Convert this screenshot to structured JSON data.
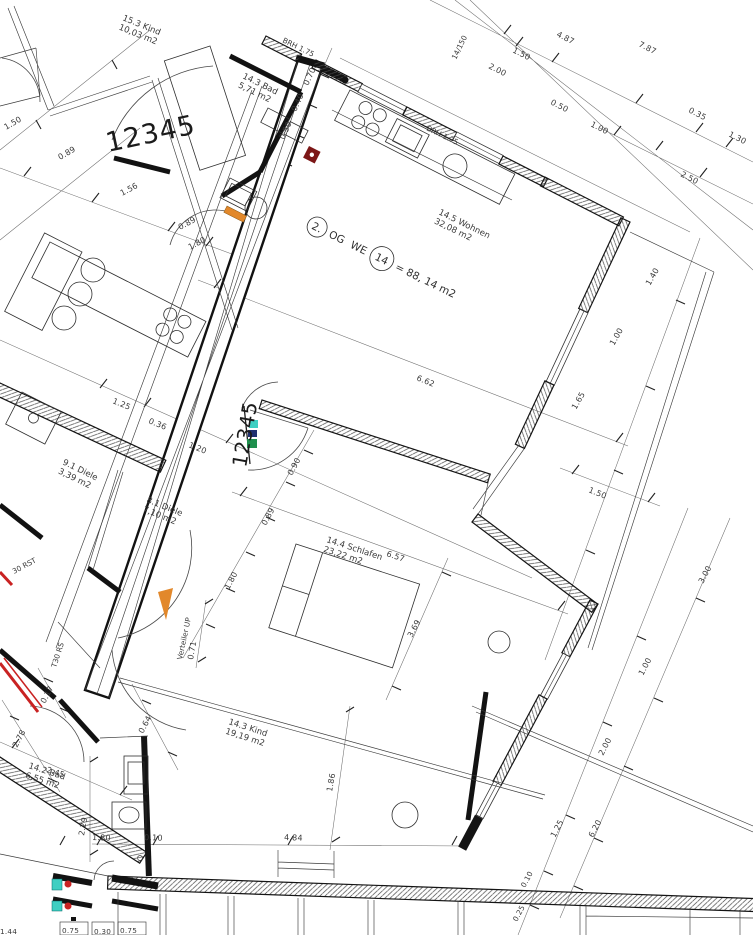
{
  "unit": {
    "floor": "2.",
    "og": "OG",
    "we": "WE",
    "number": "14",
    "area": "= 88, 14 m2"
  },
  "rooms": {
    "kind15": {
      "line1": "15.3 Kind",
      "line2": "10,03 m2"
    },
    "bad_top": {
      "line1": "14.3 Bad",
      "line2": "5,71 m2"
    },
    "wohnen": {
      "line1": "14.5 Wohnen",
      "line2": "32,08 m2"
    },
    "diele9": {
      "line1": "9.1 Diele",
      "line2": "3,39 m2"
    },
    "diele8": {
      "line1": "8.1 Diele",
      "line2": "7,10 m2"
    },
    "schlafen": {
      "line1": "14.4 Schlafen",
      "line2": "23,22 m2"
    },
    "kind14": {
      "line1": "14.3 Kind",
      "line2": "19,19 m2"
    },
    "bad_bottom": {
      "line1": "14.2 Bad",
      "line2": "6,55 m2"
    }
  },
  "stamps": {
    "a": "12345",
    "b": "12345"
  },
  "labels": {
    "brh1": "BRH 1.75",
    "brh2": "BRH 1.75",
    "stair": "14/150",
    "verteiler": "Verteiler UP",
    "t30": "T30 RS",
    "rst": "30 RST"
  },
  "dims": {
    "d01": "1.50",
    "d02": "0.89",
    "d03": "1.56",
    "d04": "0.89",
    "d05": "1.80",
    "d06": "1.50",
    "d08": "2.00",
    "d09": "4.87",
    "d10": "7.87",
    "d11": "0.50",
    "d12": "1.00",
    "d13": "0.35",
    "d14": "1.30",
    "d15": "2.50",
    "d16": "0.70",
    "d17": "0.40",
    "d18": "0.50",
    "d21": "1.40",
    "d22": "1.00",
    "d23": "1.65",
    "d24": "6.62",
    "d25": "1.50",
    "d26": "1.25",
    "d27": "0.36",
    "d28": "1.20",
    "d29": "0.90",
    "d30": "0.89",
    "d31": "1.80",
    "d32": "6.57",
    "d33": "3.69",
    "d34": "0.71",
    "d35": "0.17",
    "d36": "2.78",
    "d37": "0.64",
    "d38": "2.45",
    "d39": "2.29",
    "d40": "1.80",
    "d41": "0.10",
    "d42": "4.84",
    "d43": "1.86",
    "d44": "1.44",
    "d45": "0.75",
    "d46": "0.30",
    "d47": "0.75",
    "d48": "3.00",
    "d49": "1.00",
    "d50": "2.00",
    "d51": "6.20",
    "d52": "1.25",
    "d53": "0.10",
    "d54": "0.25"
  },
  "colors": {
    "red": "#c92222",
    "orange": "#e2882b",
    "teal": "#3fcfc2",
    "maroon": "#7c1717",
    "green": "#1f8f4d",
    "navy": "#203070",
    "wall": "#141414"
  }
}
